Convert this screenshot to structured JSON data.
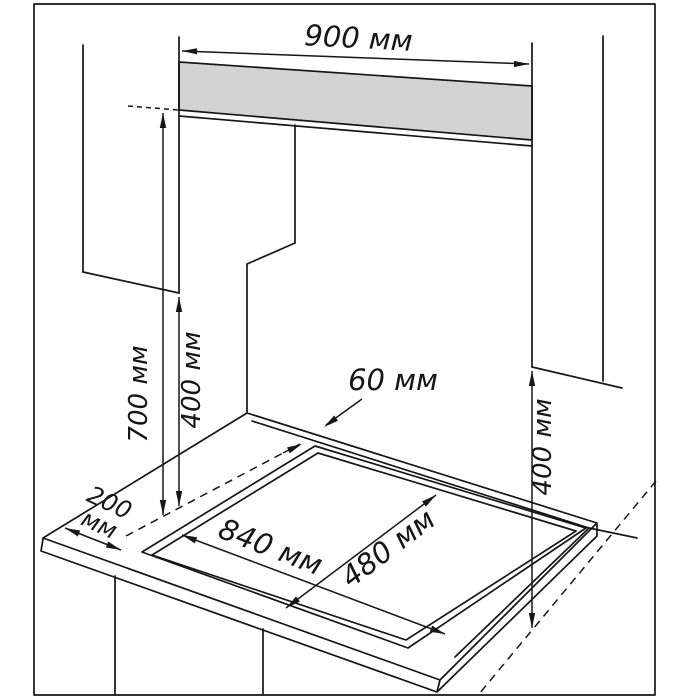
{
  "diagram": {
    "title": "hob-installation-clearance-drawing",
    "unit": "mm (мм)",
    "colors": {
      "line": "#161616",
      "band_fill": "#d3d3d3",
      "background": "#ffffff"
    },
    "labels": {
      "hood_width": "900 мм",
      "counter_to_hood_height": "700 мм",
      "left_cabinet_clearance": "400 мм",
      "right_cabinet_clearance": "400 мм",
      "rear_edge_gap": "60 мм",
      "side_gap_line1": "200",
      "side_gap_line2": "мм",
      "cutout_length": "840 мм",
      "cutout_depth": "480 мм"
    },
    "dimensions_mm": {
      "hood_width": 900,
      "counter_to_hood_height": 700,
      "left_cabinet_clearance": 400,
      "right_cabinet_clearance": 400,
      "rear_edge_gap": 60,
      "side_gap": 200,
      "cutout_length": 840,
      "cutout_depth": 480
    }
  }
}
